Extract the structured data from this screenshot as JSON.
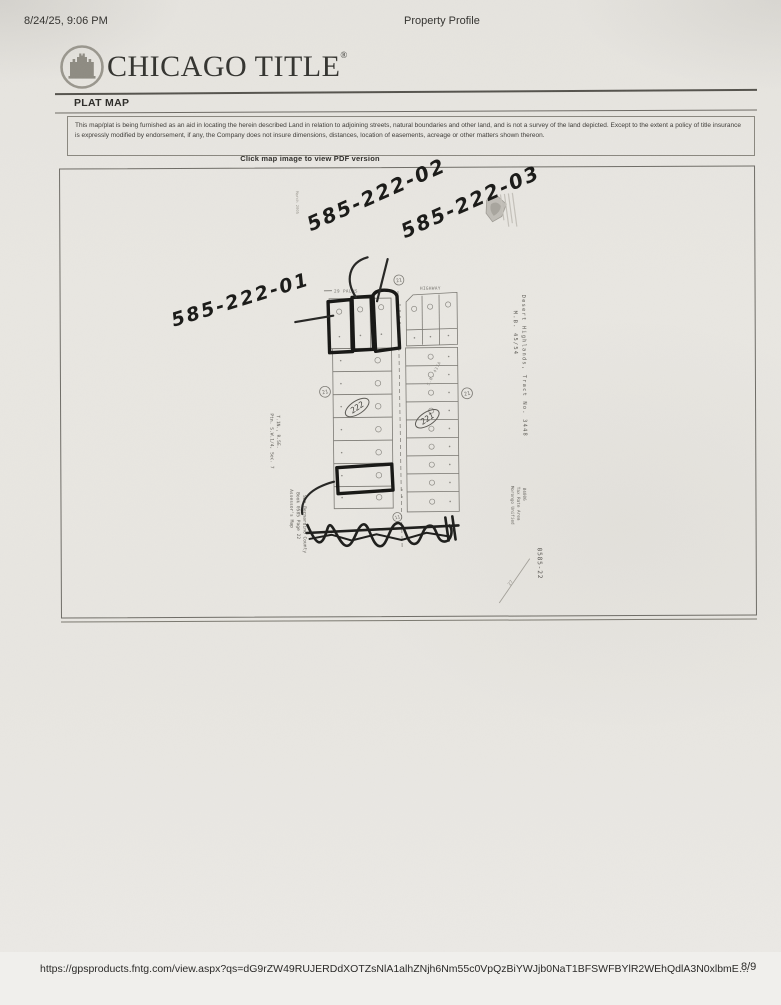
{
  "colors": {
    "paper": "#e8e6e1",
    "ink": "#1d1d1b",
    "print_gray": "#6b6b66",
    "marker_black": "#151515"
  },
  "header": {
    "timestamp": "8/24/25, 9:06 PM",
    "doc_title": "Property Profile"
  },
  "brand": {
    "name": "CHICAGO TITLE",
    "registered_mark": "®"
  },
  "section": {
    "title": "PLAT MAP",
    "disclaimer": "This map/plat is being furnished as an aid in locating the herein described Land in relation to adjoining streets, natural boundaries and other land, and is not a survey of the land depicted. Except to the extent a policy of title insurance is expressly modified by endorsement, if any, the Company does not insure dimensions, distances, location of easements, acreage or other matters shown thereon.",
    "map_caption": "Click map image to view PDF version"
  },
  "plat": {
    "handwritten": {
      "parcel_01": "585-222-01",
      "parcel_02": "585-222-02",
      "parcel_03": "585-222-03"
    },
    "streets": {
      "top_left": "29 PALMS",
      "top_right": "HIGHWAY"
    },
    "blocks": {
      "left": "222",
      "right": "221"
    },
    "corner_markers": {
      "top": "21",
      "left": "21",
      "right": "21",
      "bottom": "11"
    },
    "side_notes": {
      "date_note": "March 2005",
      "tract_line1": "Desert Highlands, Tract No. 3448",
      "tract_line2": "M.B. 45/54",
      "section_line1": "Ptn. S.W.1/4, Sec. 7",
      "section_line2": "T.1N., R.5E.",
      "assessor_line1": "Assessor's Map",
      "assessor_line2": "Book 0585 Page 22",
      "assessor_line3": "San Bernardino County",
      "tra_line1": "Morongo Unified",
      "tra_line2": "Tax Rate Area",
      "tra_line3": "84006",
      "sheet_ref": "0585-22",
      "survey_ref": "S.B. 437A",
      "pencil_note": "27"
    }
  },
  "footer": {
    "url": "https://gpsproducts.fntg.com/view.aspx?qs=dG9rZW49RUJERDdXOTZsNlA1alhZNjh6Nm55c0VpQzBiYWJjb0NaT1BFSWFBYlR2WEhQdlA3N0xlbmE…",
    "page_indicator": "8/9"
  }
}
